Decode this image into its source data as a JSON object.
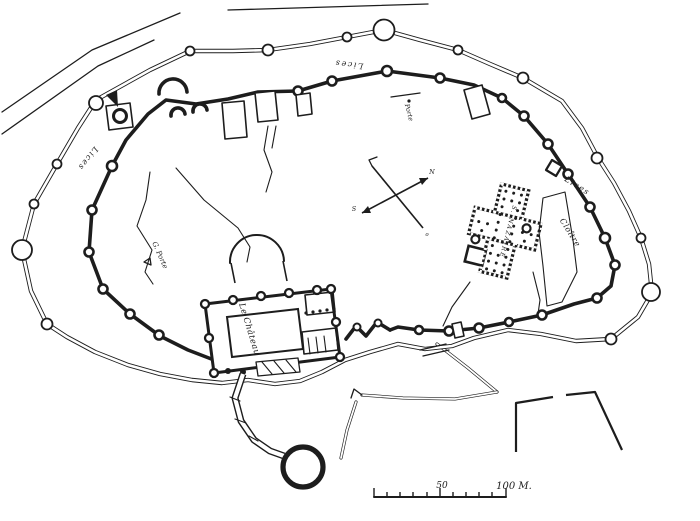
{
  "figure": {
    "background_color": "#ffffff",
    "ink_color": "#1d1d1d"
  },
  "labels": {
    "lices_top": "Lices",
    "lices_left": "Lices",
    "lices_right": "Lices",
    "porte_north": "Porte",
    "grande_porte": "G. Porte",
    "chateau": "Le Château",
    "church": "S. NAZAIRE",
    "cloitre": "Cloître"
  },
  "compass": {
    "ne_letter": "N",
    "sw_letter": "S",
    "se_letter": "o"
  },
  "scale_bar": {
    "mid_label": "50",
    "end_label": "100 M."
  }
}
